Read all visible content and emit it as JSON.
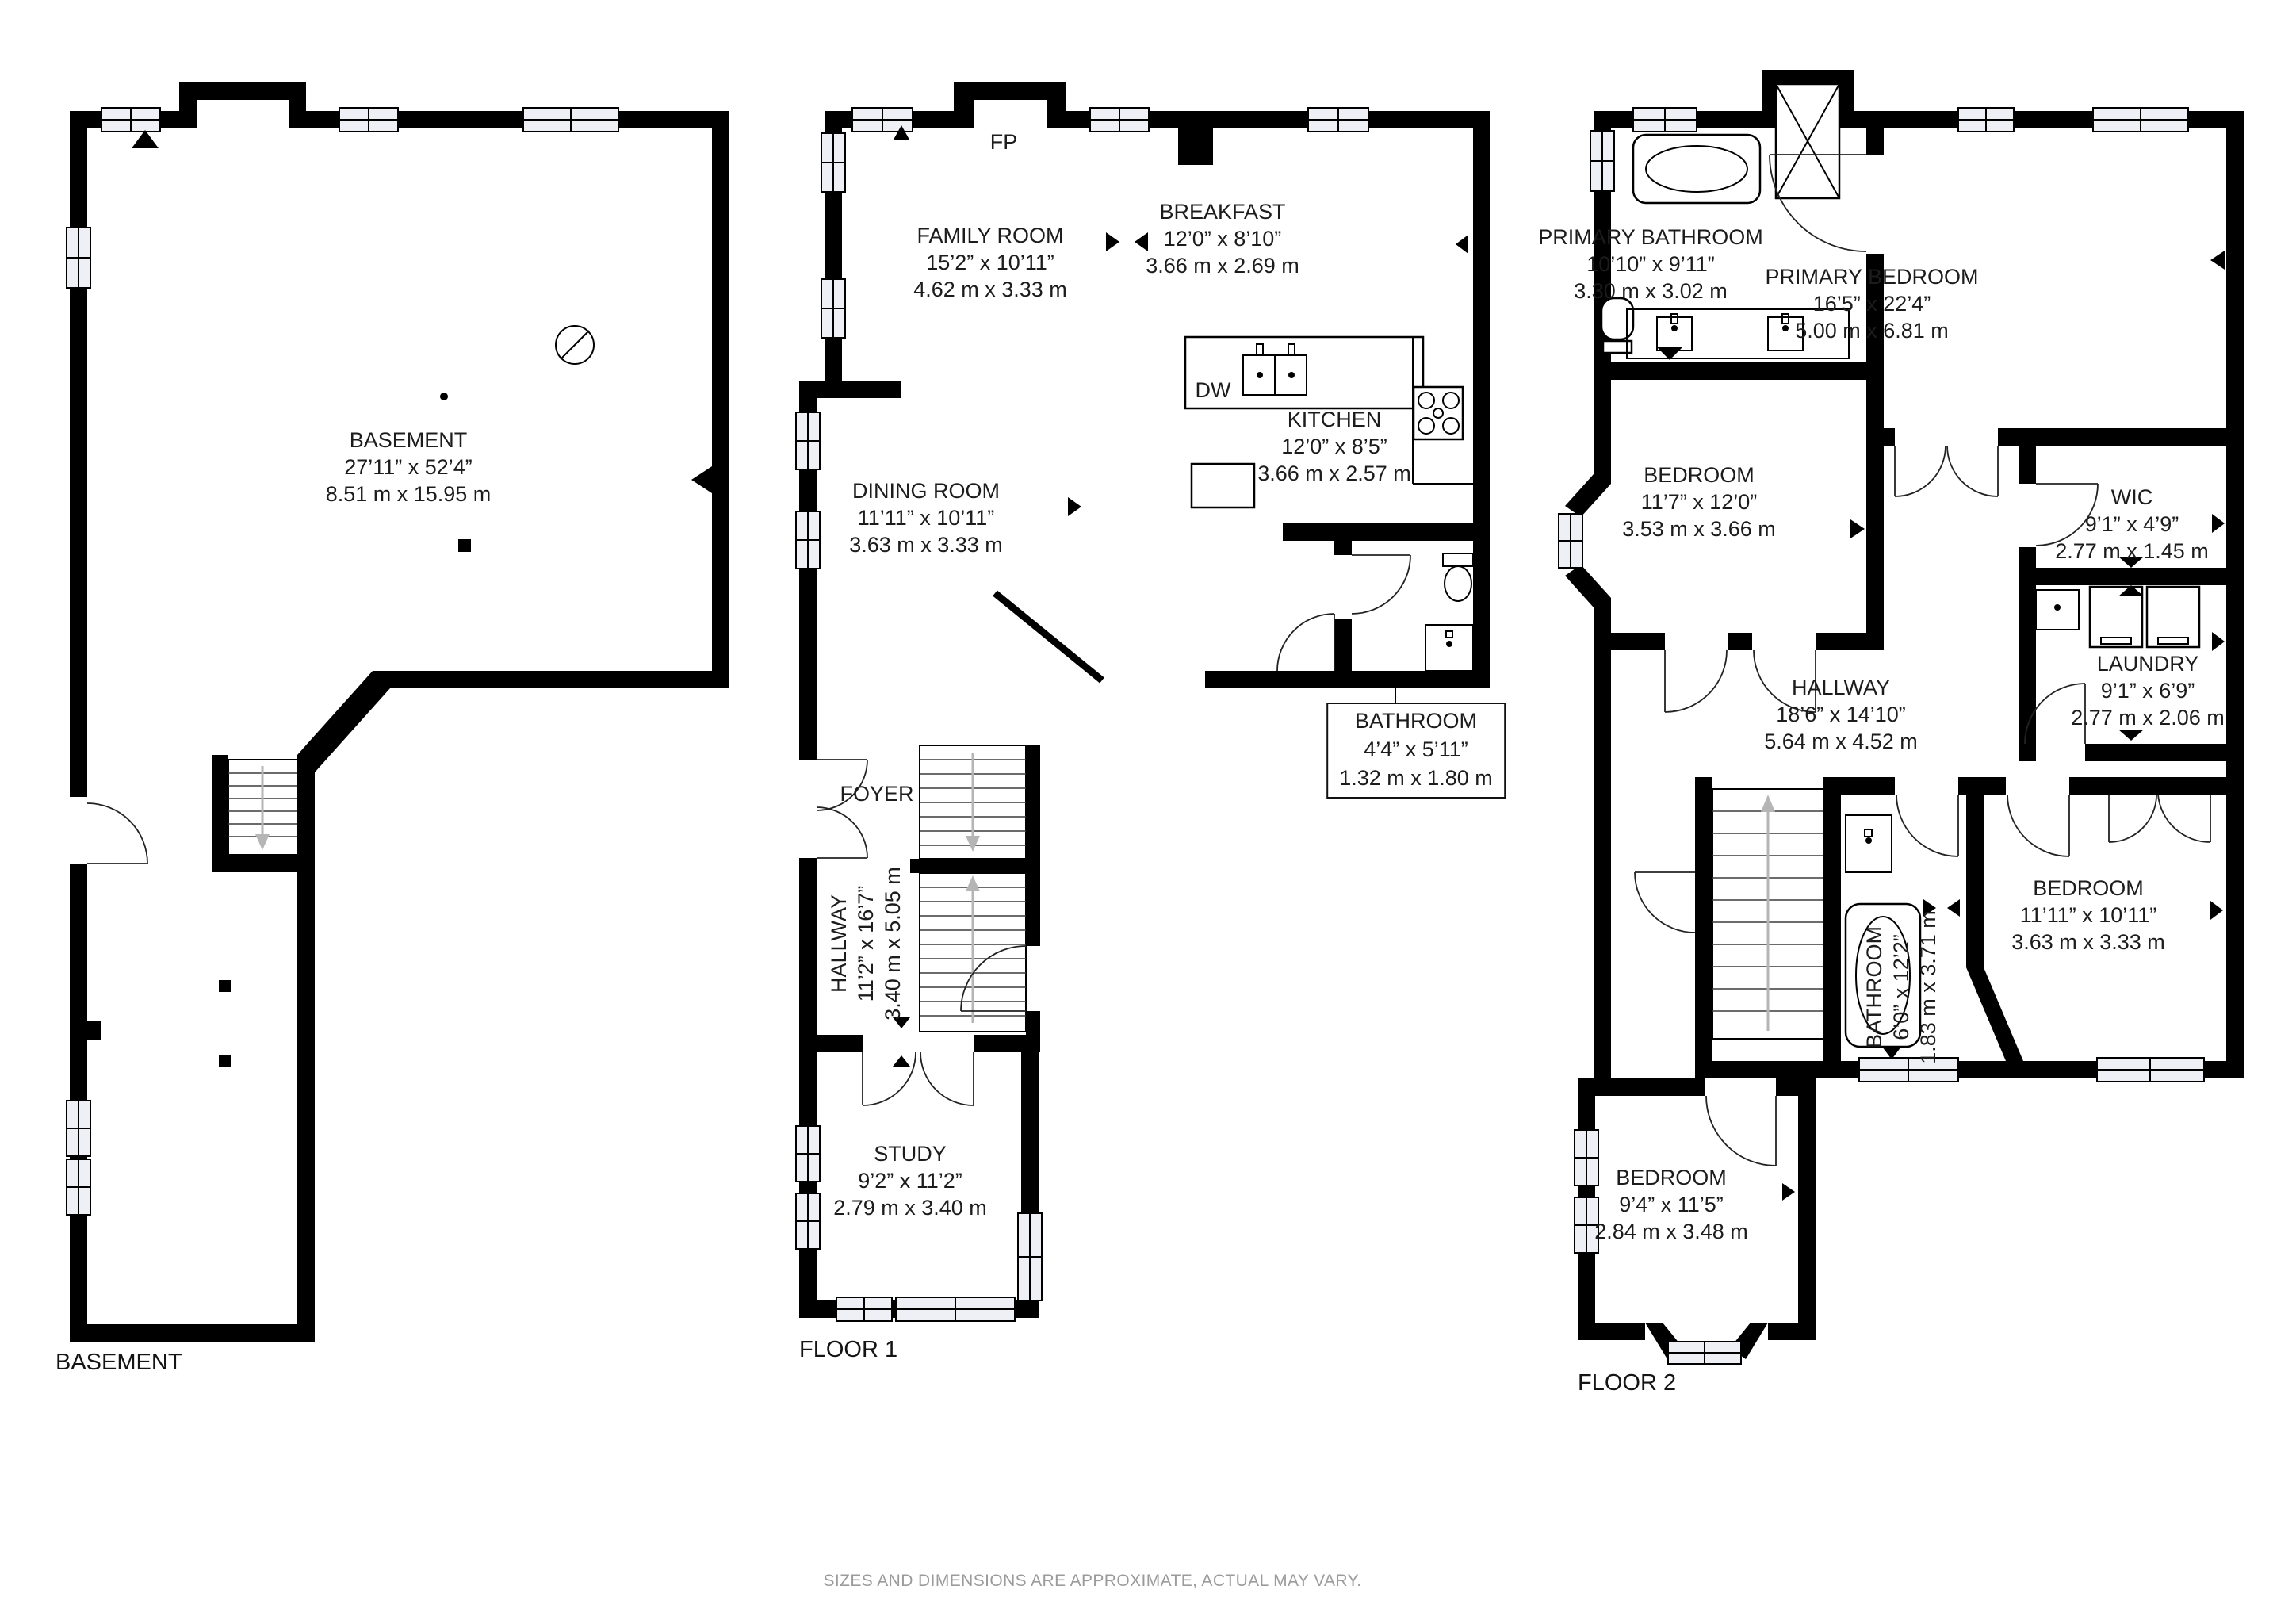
{
  "page": {
    "disclaimer": "SIZES AND DIMENSIONS ARE APPROXIMATE, ACTUAL MAY VARY.",
    "colors": {
      "wall": "#000000",
      "text": "#1c1c1c",
      "muted": "#9b9b9b",
      "window_fill": "#eef0f6"
    }
  },
  "floors": [
    {
      "title": "BASEMENT",
      "rooms": [
        {
          "name": "BASEMENT",
          "imperial": "27’11” x 52’4”",
          "metric": "8.51 m x 15.95 m"
        }
      ]
    },
    {
      "title": "FLOOR 1",
      "rooms": [
        {
          "name": "FAMILY ROOM",
          "imperial": "15’2” x 10’11”",
          "metric": "4.62 m x 3.33 m"
        },
        {
          "name": "BREAKFAST",
          "imperial": "12’0” x 8’10”",
          "metric": "3.66 m x 2.69 m"
        },
        {
          "name": "KITCHEN",
          "imperial": "12’0” x 8’5”",
          "metric": "3.66 m x 2.57 m"
        },
        {
          "name": "DINING ROOM",
          "imperial": "11’11” x 10’11”",
          "metric": "3.63 m x 3.33 m"
        },
        {
          "name": "BATHROOM",
          "imperial": "4’4” x 5’11”",
          "metric": "1.32 m x 1.80 m"
        },
        {
          "name": "FOYER"
        },
        {
          "name": "HALLWAY",
          "imperial": "11’2” x 16’7”",
          "metric": "3.40 m x 5.05 m"
        },
        {
          "name": "STUDY",
          "imperial": "9’2” x 11’2”",
          "metric": "2.79 m x 3.40 m"
        }
      ],
      "annotations": [
        {
          "label": "FP"
        },
        {
          "label": "DW"
        }
      ]
    },
    {
      "title": "FLOOR 2",
      "rooms": [
        {
          "name": "PRIMARY BATHROOM",
          "imperial": "10’10” x 9’11”",
          "metric": "3.30 m x 3.02 m"
        },
        {
          "name": "PRIMARY BEDROOM",
          "imperial": "16’5” x 22’4”",
          "metric": "5.00 m x 6.81 m"
        },
        {
          "name": "BEDROOM",
          "imperial": "11’7” x 12’0”",
          "metric": "3.53 m x 3.66 m"
        },
        {
          "name": "WIC",
          "imperial": "9’1” x 4’9”",
          "metric": "2.77 m x 1.45 m"
        },
        {
          "name": "LAUNDRY",
          "imperial": "9’1” x 6’9”",
          "metric": "2.77 m x 2.06 m"
        },
        {
          "name": "HALLWAY",
          "imperial": "18’6” x 14’10”",
          "metric": "5.64 m x 4.52 m"
        },
        {
          "name": "BATHROOM",
          "imperial": "6’0” x 12’2”",
          "metric": "1.83 m x 3.71 m"
        },
        {
          "name": "BEDROOM",
          "imperial": "11’11” x 10’11”",
          "metric": "3.63 m x 3.33 m"
        },
        {
          "name": "BEDROOM",
          "imperial": "9’4” x 11’5”",
          "metric": "2.84 m x 3.48 m"
        }
      ]
    }
  ]
}
